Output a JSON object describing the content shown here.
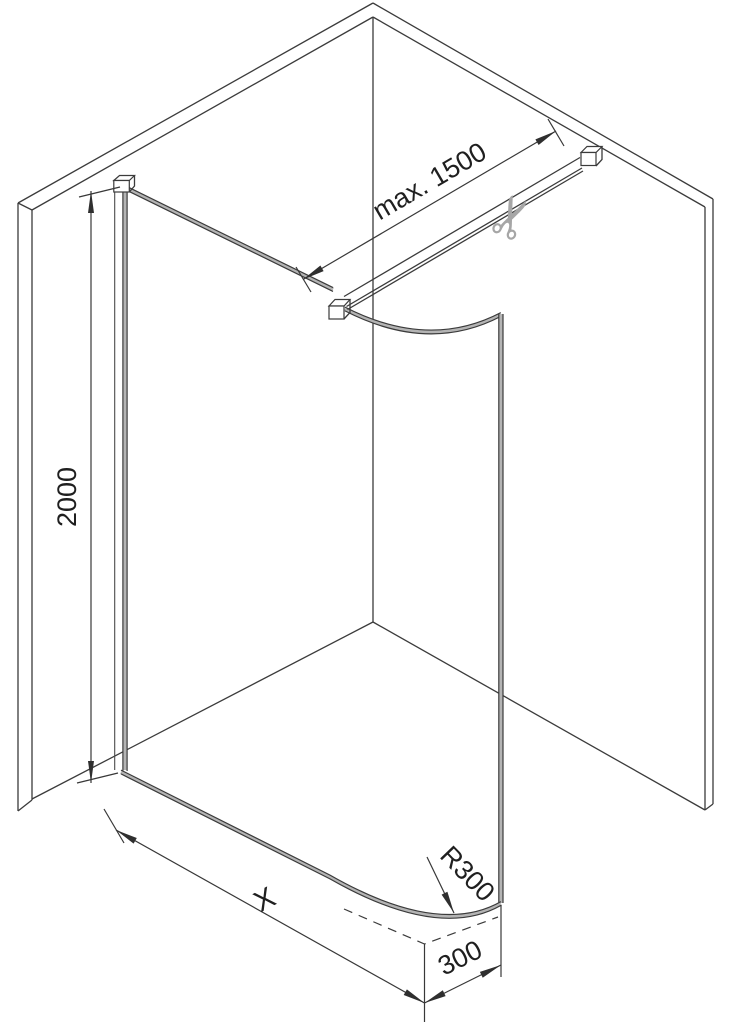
{
  "diagram": {
    "labels": {
      "bar_max_length": "max. 1500",
      "height": "2000",
      "width": "X",
      "corner_radius": "R300",
      "corner_depth": "300"
    },
    "icons": {
      "scissors": "✂"
    },
    "colors": {
      "background": "#ffffff",
      "line": "#3b3b3b",
      "glass_edge_fill": "#b4b4b4",
      "scissors_gray": "#a6a6a6",
      "text": "#1f1f1f"
    }
  }
}
